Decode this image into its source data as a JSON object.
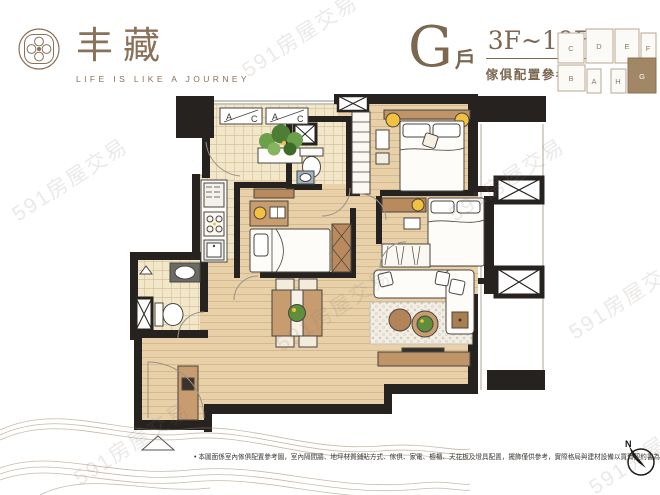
{
  "brand": {
    "name": "丰藏",
    "tagline": "LIFE IS LIKE A JOURNEY"
  },
  "unit_header": {
    "unit_letter": "G",
    "unit_suffix": "戶",
    "floor_range": "3F~19F",
    "caption": "傢俱配置參考圖"
  },
  "keyplan": {
    "units": [
      "C",
      "D",
      "E",
      "F",
      "B",
      "A",
      "H",
      "G"
    ],
    "highlighted_unit": "G"
  },
  "plan": {
    "ac_label_a": "A",
    "ac_label_c": "C"
  },
  "footer": {
    "bullet": "•",
    "disclaimer": "本圖面係室內傢俱配置參考圖，室內隔間牆、地坪材質鋪貼方式、傢俱、家電、櫥櫃、天花板及燈具配置，擺飾僅供參考，實際格局與建材設備以買賣契約書為準。",
    "compass_label": "N"
  },
  "watermark": {
    "text": "591房屋交易"
  },
  "colors": {
    "brand_brown": "#8a7158",
    "wall_black": "#262220",
    "wood_floor": "#e8d0a9",
    "tile_floor": "#f2e7c9",
    "furniture_brown": "#bf9469",
    "accent_yellow": "#f1c13f",
    "plant_green": "#5d8f3d",
    "keyplan_highlight": "#a28766"
  }
}
